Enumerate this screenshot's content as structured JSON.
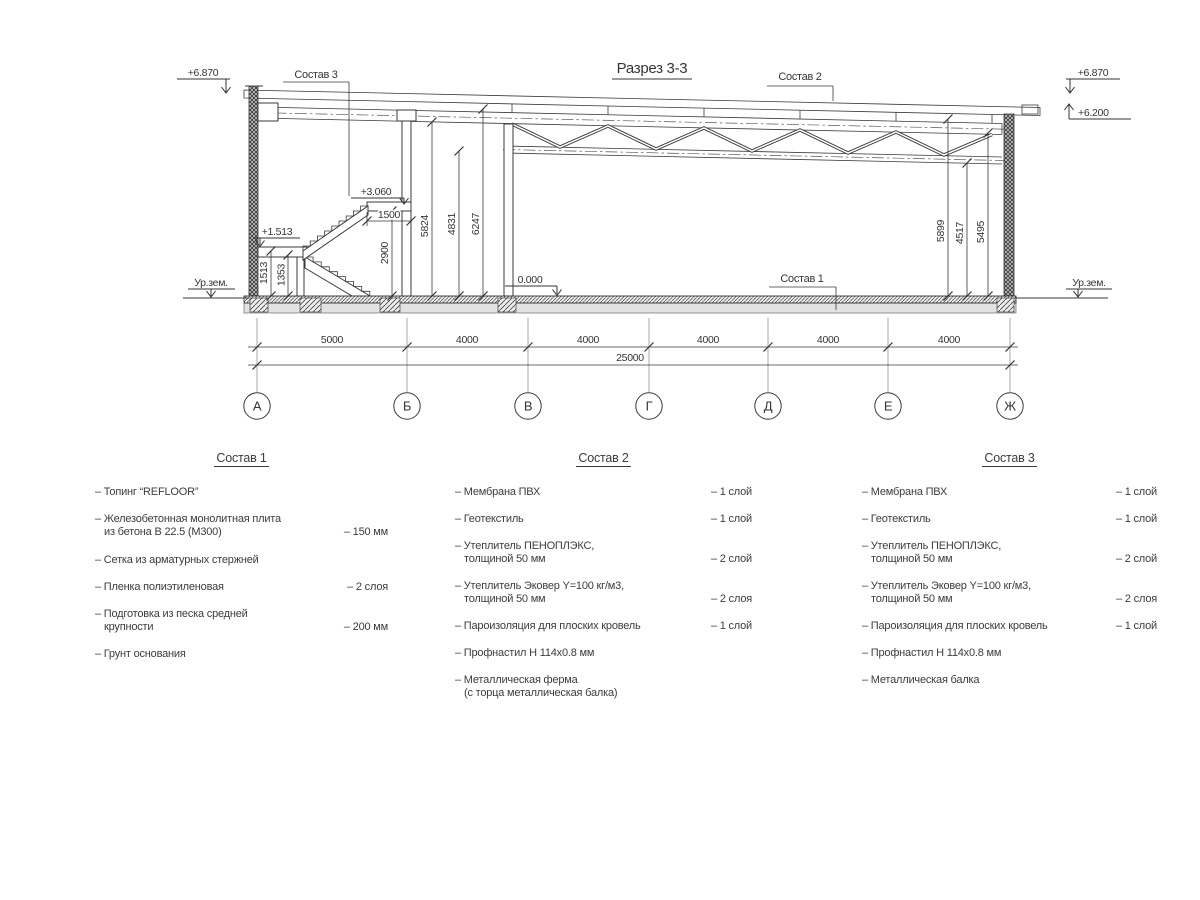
{
  "title": "Разрез 3-3",
  "drawing": {
    "elevations": {
      "top_left": "+6.870",
      "top_right": "+6.870",
      "truss_bearing": "+6.200",
      "stair_landing_top": "+3.060",
      "stair_landing_mid": "+1.513",
      "floor": "0.000",
      "ground_left": "Ур.зем.",
      "ground_right": "Ур.зем."
    },
    "leader_labels": {
      "sostav1": "Состав 1",
      "sostav2": "Состав 2",
      "sostav3": "Состав 3"
    },
    "dims": {
      "v1513": "1513",
      "v1353": "1353",
      "v2900": "2900",
      "h1500": "1500",
      "v5824": "5824",
      "v4831": "4831",
      "v6247": "6247",
      "v5899": "5899",
      "v4517": "4517",
      "v5495": "5495",
      "spans": [
        "5000",
        "4000",
        "4000",
        "4000",
        "4000",
        "4000"
      ],
      "total": "25000"
    },
    "axes": [
      "А",
      "Б",
      "В",
      "Г",
      "Д",
      "Е",
      "Ж"
    ]
  },
  "compositions": [
    {
      "title": "Состав 1",
      "items": [
        {
          "l1": "– Топинг “REFLOOR”",
          "l2": "",
          "value": ""
        },
        {
          "l1": "– Железобетонная  монолитная плита",
          "l2": "из бетона В 22.5 (М300)",
          "value": "– 150 мм"
        },
        {
          "l1": "– Сетка из арматурных стержней",
          "l2": "",
          "value": ""
        },
        {
          "l1": "– Пленка полиэтиленовая",
          "l2": "",
          "value": "–  2 слоя"
        },
        {
          "l1": "– Подготовка из песка средней",
          "l2": "крупности",
          "value": "– 200 мм"
        },
        {
          "l1": "– Грунт основания",
          "l2": "",
          "value": ""
        }
      ]
    },
    {
      "title": "Состав 2",
      "items": [
        {
          "l1": "– Мембрана ПВХ",
          "l2": "",
          "value": "– 1 слой"
        },
        {
          "l1": "– Геотекстиль",
          "l2": "",
          "value": "– 1 слой"
        },
        {
          "l1": "– Утеплитель ПЕНОПЛЭКС,",
          "l2": "толщиной 50 мм",
          "value": "– 2 слой"
        },
        {
          "l1": "– Утеплитель Эковер Y=100 кг/м3,",
          "l2": "толщиной 50 мм",
          "value": "– 2 слоя"
        },
        {
          "l1": "– Пароизоляция для плоских кровель",
          "l2": "",
          "value": "– 1 слой"
        },
        {
          "l1": "– Профнастил Н 114х0.8 мм",
          "l2": "",
          "value": ""
        },
        {
          "l1": "– Металлическая ферма",
          "l2": "(с торца металлическая балка)",
          "value": ""
        }
      ]
    },
    {
      "title": "Состав 3",
      "items": [
        {
          "l1": "– Мембрана ПВХ",
          "l2": "",
          "value": "– 1 слой"
        },
        {
          "l1": "– Геотекстиль",
          "l2": "",
          "value": "– 1 слой"
        },
        {
          "l1": "– Утеплитель ПЕНОПЛЭКС,",
          "l2": "толщиной 50 мм",
          "value": "– 2 слой"
        },
        {
          "l1": "– Утеплитель Эковер Y=100 кг/м3,",
          "l2": "толщиной 50 мм",
          "value": "– 2 слоя"
        },
        {
          "l1": "– Пароизоляция для плоских кровель",
          "l2": "",
          "value": "– 1 слой"
        },
        {
          "l1": "– Профнастил Н 114х0.8 мм",
          "l2": "",
          "value": ""
        },
        {
          "l1": "– Металлическая балка",
          "l2": "",
          "value": ""
        }
      ]
    }
  ]
}
